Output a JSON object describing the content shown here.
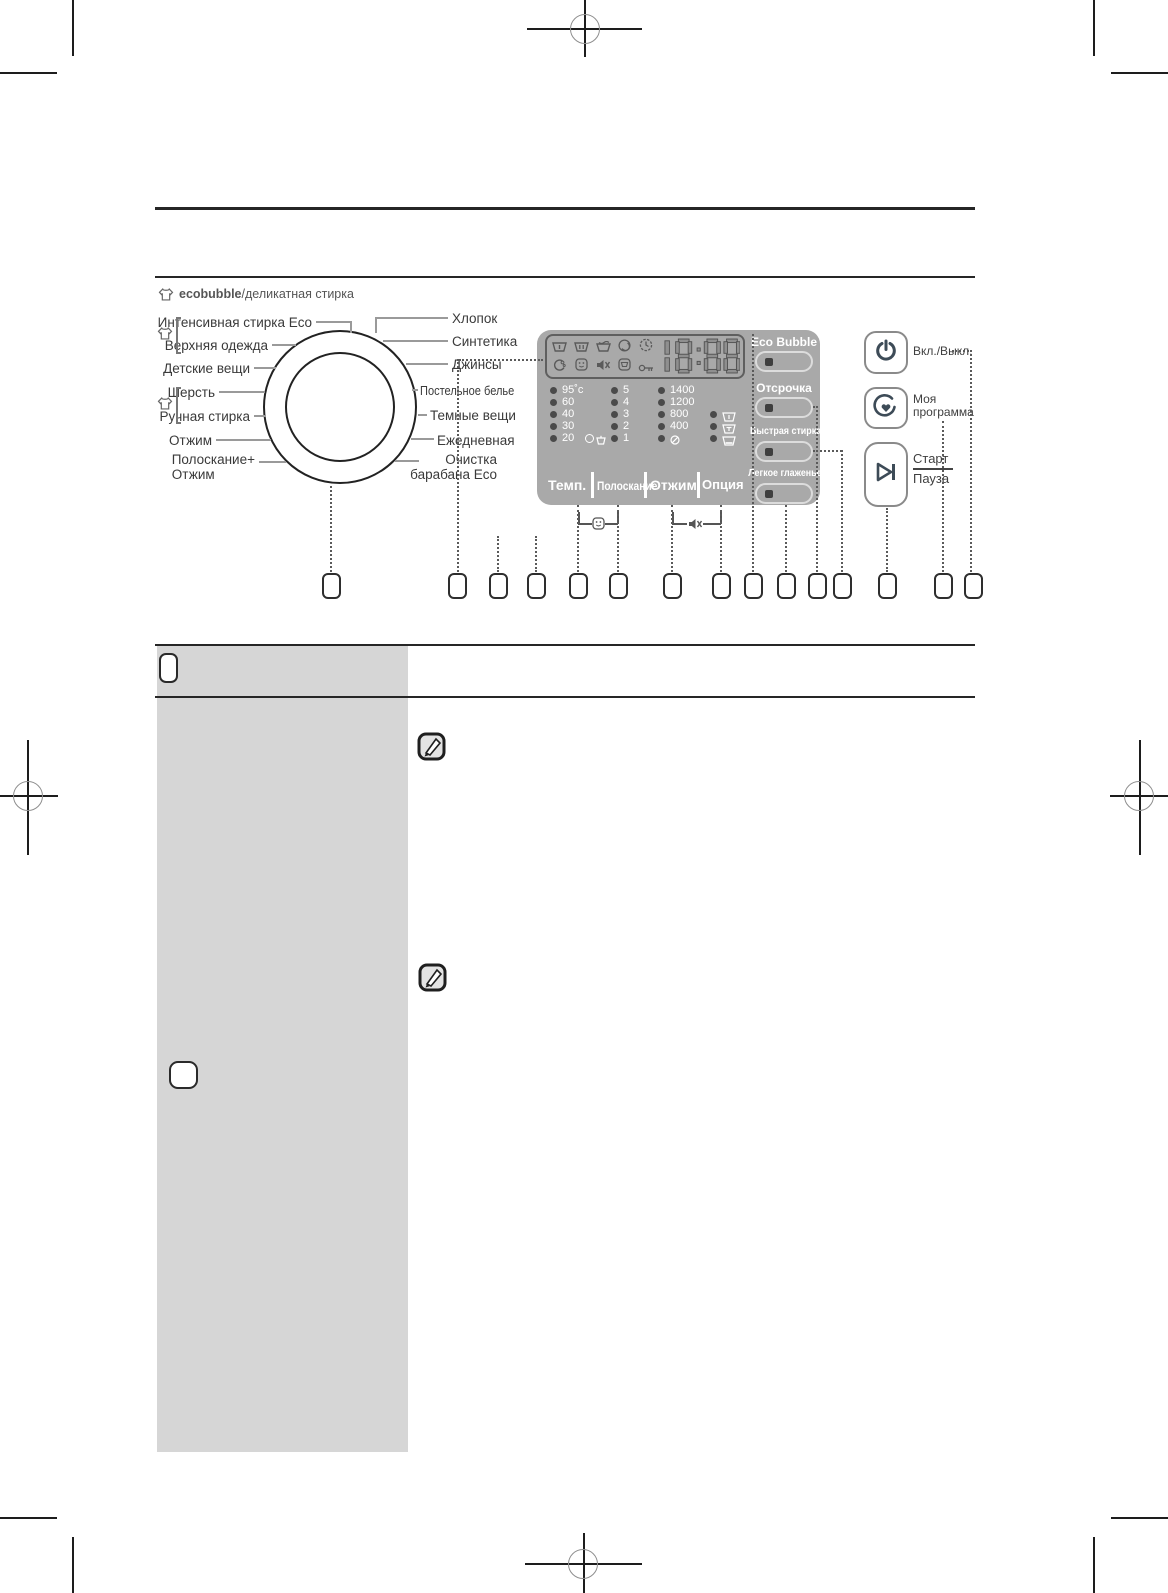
{
  "colors": {
    "panel_gray": "#a9a9a9",
    "table_gray": "#d6d6d6",
    "ink": "#222222",
    "button_slate": "#3d4b57",
    "connector_gray": "#9a9a9a"
  },
  "diagram": {
    "caption_brand": "ecobubble",
    "caption_rest": "/деликатная стирка",
    "dial": {
      "left_labels": [
        "Интенсивная стирка Eco",
        "Верхняя одежда",
        "Детские вещи",
        "Шерсть",
        "Ручная стирка",
        "Отжим",
        "Полоскание+\nОтжим"
      ],
      "right_labels": [
        "Хлопок",
        "Синтетика",
        "Джинсы",
        "Постельное белье",
        "Темные вещи",
        "Ежедневная",
        "Очистка\nбарабана Eco"
      ]
    },
    "display": {
      "time": "18:88",
      "status_icons_row1": [
        "prewash-tub-icon",
        "mainwash-tub-icon",
        "rinse-tub-icon",
        "spin-icon",
        "delay-clock-icon"
      ],
      "status_icons_row2": [
        "ecobubble-icon",
        "child-lock-icon",
        "sound-off-icon",
        "door-lock-icon",
        "key-icon"
      ],
      "temp_levels": [
        "95˚c",
        "60",
        "40",
        "30",
        "20"
      ],
      "rinse_levels": [
        "5",
        "4",
        "3",
        "2",
        "1"
      ],
      "spin_levels": [
        "1400",
        "1200",
        "800",
        "400"
      ],
      "no_spin_icon": "no-spin-icon",
      "option_row_icons": [
        "prewash-option-icon",
        "intensive-option-icon",
        "soak-option-icon"
      ],
      "selector_labels": [
        "Темп.",
        "Полоскание",
        "Отжим",
        "Опция"
      ],
      "option_buttons": [
        "Eco Bubble",
        "Отсрочка",
        "Быстрая стирка",
        "Легкое глаженье"
      ]
    },
    "combo_hints": [
      {
        "icon": "child-lock-icon"
      },
      {
        "icon": "sound-off-icon"
      }
    ],
    "right_buttons": {
      "power_label": "Вкл./Выкл.",
      "my_program_label": "Моя программа",
      "start_label": "Старт",
      "pause_label": "Пауза"
    }
  }
}
